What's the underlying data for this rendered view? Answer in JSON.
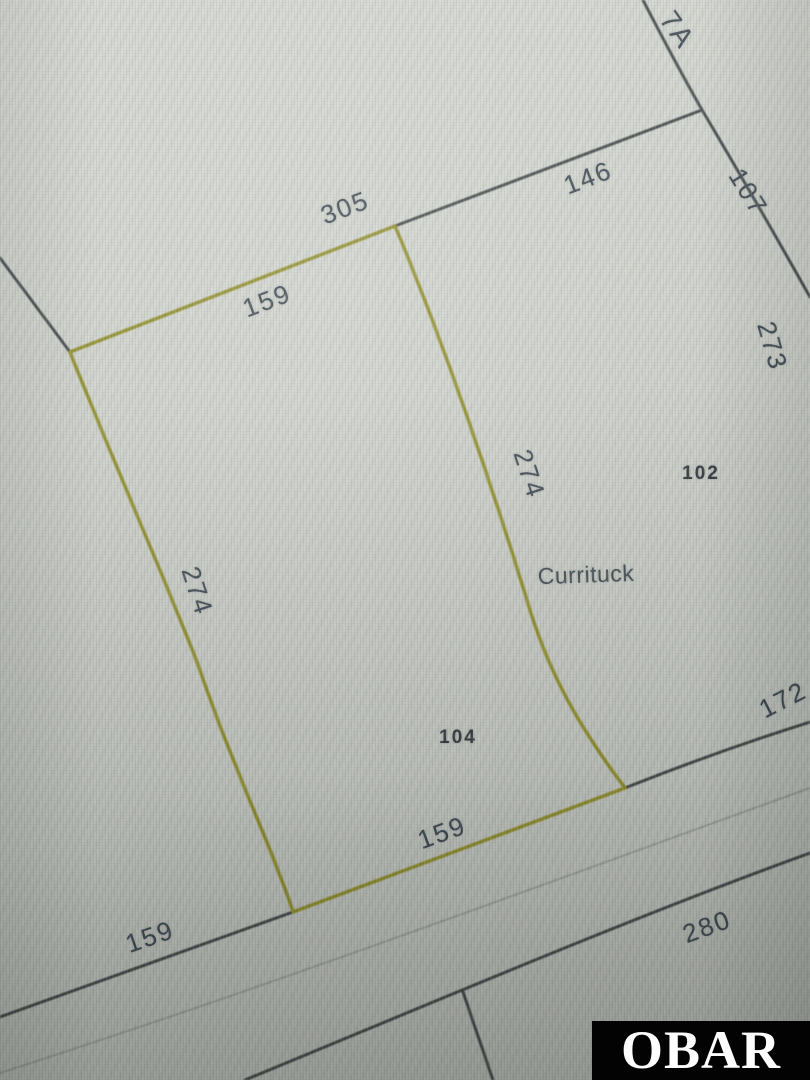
{
  "map": {
    "county": {
      "text": "Currituck"
    },
    "lots": {
      "lot_7a": {
        "text": "7A"
      },
      "lot_102": {
        "text": "102"
      },
      "lot_104": {
        "text": "104"
      }
    },
    "dimensions": {
      "nw_outer_305": {
        "text": "305"
      },
      "ne_146": {
        "text": "146"
      },
      "ne_side_107": {
        "text": "107"
      },
      "e_side_273": {
        "text": "273"
      },
      "nw_inner_159": {
        "text": "159"
      },
      "east_274": {
        "text": "274"
      },
      "west_274": {
        "text": "274"
      },
      "south_159": {
        "text": "159"
      },
      "sw_road_159": {
        "text": "159"
      },
      "road_280": {
        "text": "280"
      },
      "se_172": {
        "text": "172"
      }
    }
  },
  "watermark": {
    "text": "OBAR",
    "background": "#030303",
    "color": "#fdfdfd"
  },
  "colors": {
    "screen_background": "#cfd2cb",
    "parcel_line": "#3e4447",
    "highlighted_parcel_line": "#8f8d26",
    "road_centerline": "#9ba09b",
    "label_text": "#3a444e"
  }
}
